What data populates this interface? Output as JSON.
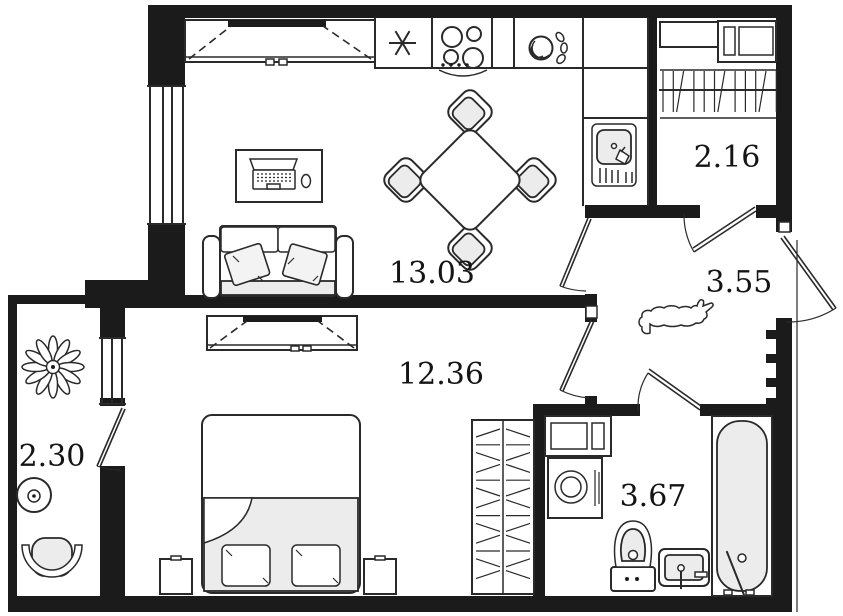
{
  "plan": {
    "type": "apartment-floor-plan",
    "colors": {
      "walls": "#1b1b1b",
      "lines": "#2a2a2a",
      "background": "#ffffff",
      "furniture_fill": "#ececec"
    }
  },
  "rooms": [
    {
      "id": "kitchen-living-room",
      "area": "13.03"
    },
    {
      "id": "bedroom",
      "area": "12.36"
    },
    {
      "id": "wardrobe-closet",
      "area": "2.16"
    },
    {
      "id": "hallway",
      "area": "3.55"
    },
    {
      "id": "bathroom",
      "area": "3.67"
    },
    {
      "id": "balcony",
      "area": "2.30"
    }
  ],
  "symbols": [
    "fridge-icon",
    "hob-icon",
    "dish-rack-icon",
    "kitchen-sink-icon",
    "dining-table",
    "dining-chair",
    "desk-laptop",
    "mouse-icon",
    "sofa",
    "sliding-wardrobe",
    "bed",
    "nightstand",
    "hatched-wardrobe",
    "closet-shelves",
    "hanging-rail",
    "cat-icon",
    "entrance-door",
    "washing-machine",
    "wall-cabinet",
    "toilet",
    "washbasin",
    "bathtub",
    "plant-icon",
    "balcony-table",
    "balcony-chair",
    "door-swing",
    "window"
  ]
}
